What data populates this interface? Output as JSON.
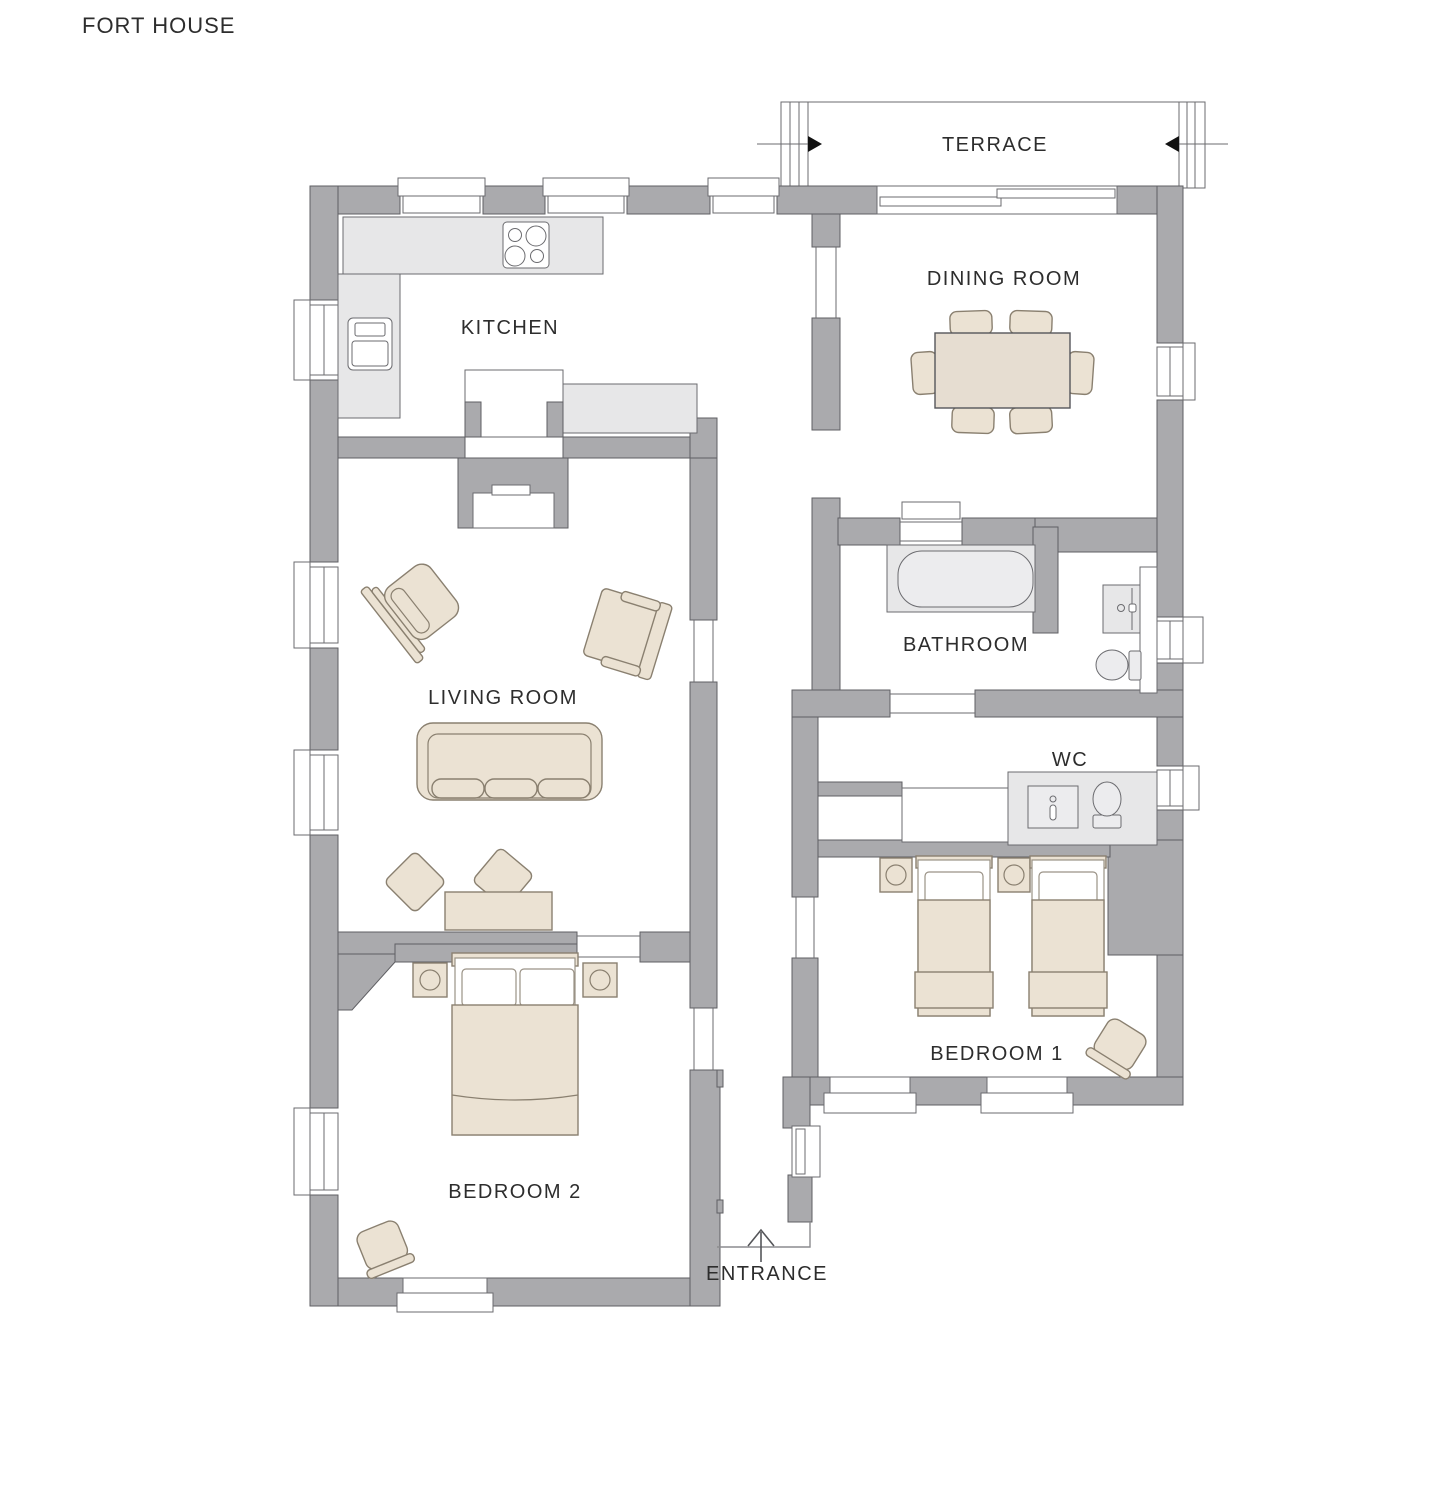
{
  "title": "FORT HOUSE",
  "rooms": {
    "terrace": {
      "label": "TERRACE"
    },
    "dining_room": {
      "label": "DINING ROOM"
    },
    "kitchen": {
      "label": "KITCHEN"
    },
    "living_room": {
      "label": "LIVING ROOM"
    },
    "bathroom": {
      "label": "BATHROOM"
    },
    "wc": {
      "label": "WC"
    },
    "bedroom_1": {
      "label": "BEDROOM 1"
    },
    "bedroom_2": {
      "label": "BEDROOM 2"
    },
    "entrance": {
      "label": "ENTRANCE"
    }
  },
  "furniture": {
    "kitchen": [
      "L-shaped counter",
      "hob with 4 burners",
      "sink"
    ],
    "dining_room": [
      "dining table",
      "six chairs"
    ],
    "living_room": [
      "three-seat sofa",
      "two armchairs",
      "two ottomans",
      "coffee table",
      "fireplace"
    ],
    "bathroom": [
      "bathtub",
      "washbasin",
      "toilet"
    ],
    "wc": [
      "washbasin",
      "toilet",
      "counter"
    ],
    "bedroom_1": [
      "two single beds",
      "two nightstands with lamps",
      "chair"
    ],
    "bedroom_2": [
      "double bed",
      "two nightstands with lamps",
      "chair"
    ]
  },
  "colors": {
    "wall": "#aaaaad",
    "wall_outline": "#5f5f63",
    "fixture": "#e7e7e8",
    "furniture": "#ebe2d3",
    "furniture_outline": "#8a8070",
    "text": "#2d2d2d",
    "arrow": "#111111"
  }
}
